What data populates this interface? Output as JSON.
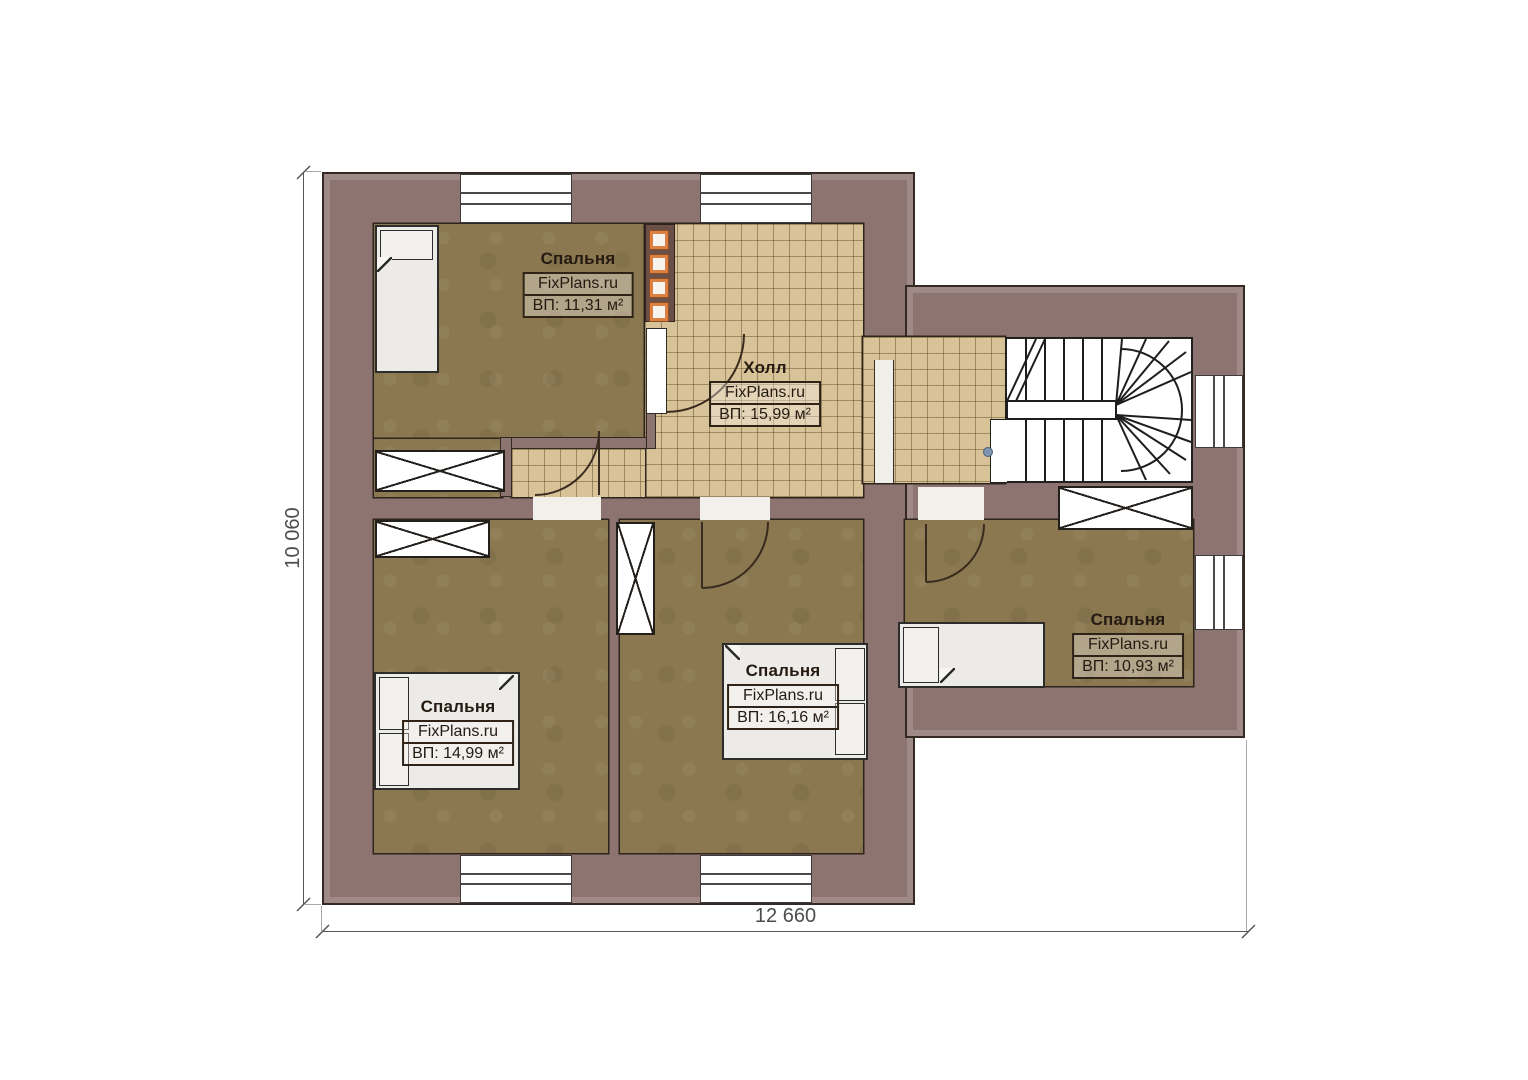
{
  "plan": {
    "title": "Floor plan — second floor",
    "watermark": "FixPlans.ru",
    "dimensions": {
      "width": "12 660",
      "height": "10 060"
    },
    "rooms": [
      {
        "id": "bedroom-top-left",
        "name": "Спальня",
        "area": "ВП: 11,31 м²"
      },
      {
        "id": "hall",
        "name": "Холл",
        "area": "ВП: 15,99 м²"
      },
      {
        "id": "bedroom-bottom-left",
        "name": "Спальня",
        "area": "ВП: 14,99 м²"
      },
      {
        "id": "bedroom-bottom-middle",
        "name": "Спальня",
        "area": "ВП: 16,16 м²"
      },
      {
        "id": "bedroom-right",
        "name": "Спальня",
        "area": "ВП: 10,93 м²"
      }
    ],
    "colors": {
      "wall": "#8d7470",
      "tile_floor": "#d8c297",
      "carpet_floor": "#8b7850",
      "accent_orange": "#dd7f3f",
      "dimension_text": "#4c4c4c"
    }
  }
}
